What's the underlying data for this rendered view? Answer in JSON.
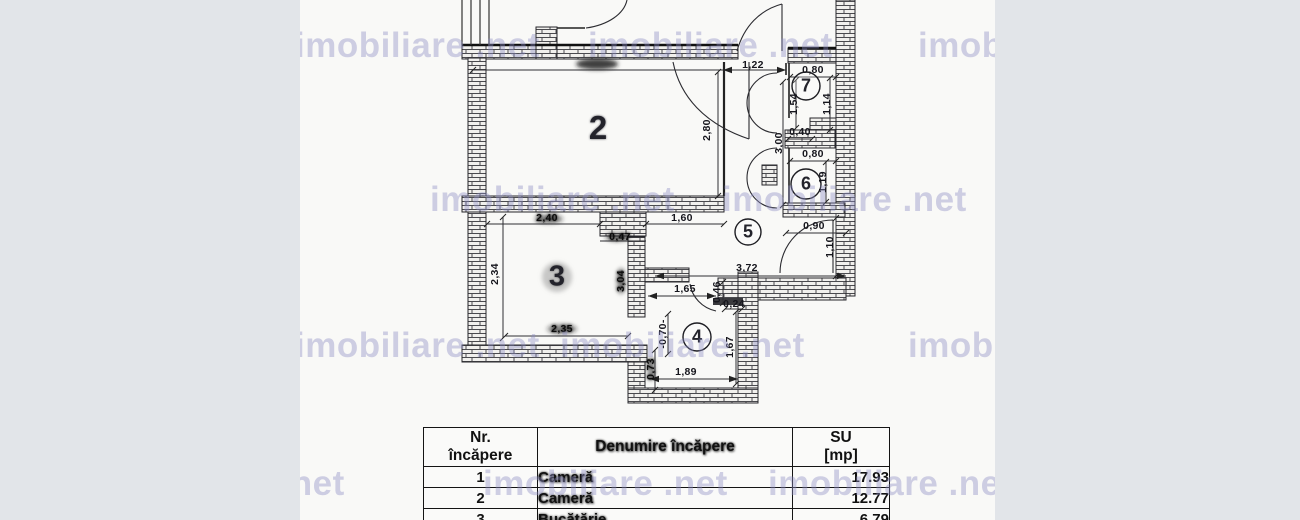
{
  "watermark": {
    "text": "imobiliare .net"
  },
  "plan": {
    "rooms": [
      "2",
      "3",
      "4",
      "5",
      "6",
      "7"
    ],
    "dims": [
      "1,22",
      "0,80",
      "1,54",
      "1,14",
      "0,40",
      "3,00",
      "0,80",
      "1,19",
      "0,90",
      "1,10",
      "3,72",
      "2,80",
      "2,40",
      "0,47",
      "1,60",
      "2,34",
      "3,04",
      "2,35",
      "1,65",
      "0,46",
      "0,24",
      "-0,70-",
      "0,73",
      "1,67",
      "1,89"
    ]
  },
  "table": {
    "headers": {
      "nr": "Nr.\nîncăpere",
      "name": "Denumire încăpere",
      "su": "SU\n[mp]"
    },
    "rows": [
      {
        "nr": "1",
        "name": "Cameră",
        "su": "17.93"
      },
      {
        "nr": "2",
        "name": "Cameră",
        "su": "12.77"
      },
      {
        "nr": "3",
        "name": "Bucătărie",
        "su": "6.79"
      }
    ]
  }
}
